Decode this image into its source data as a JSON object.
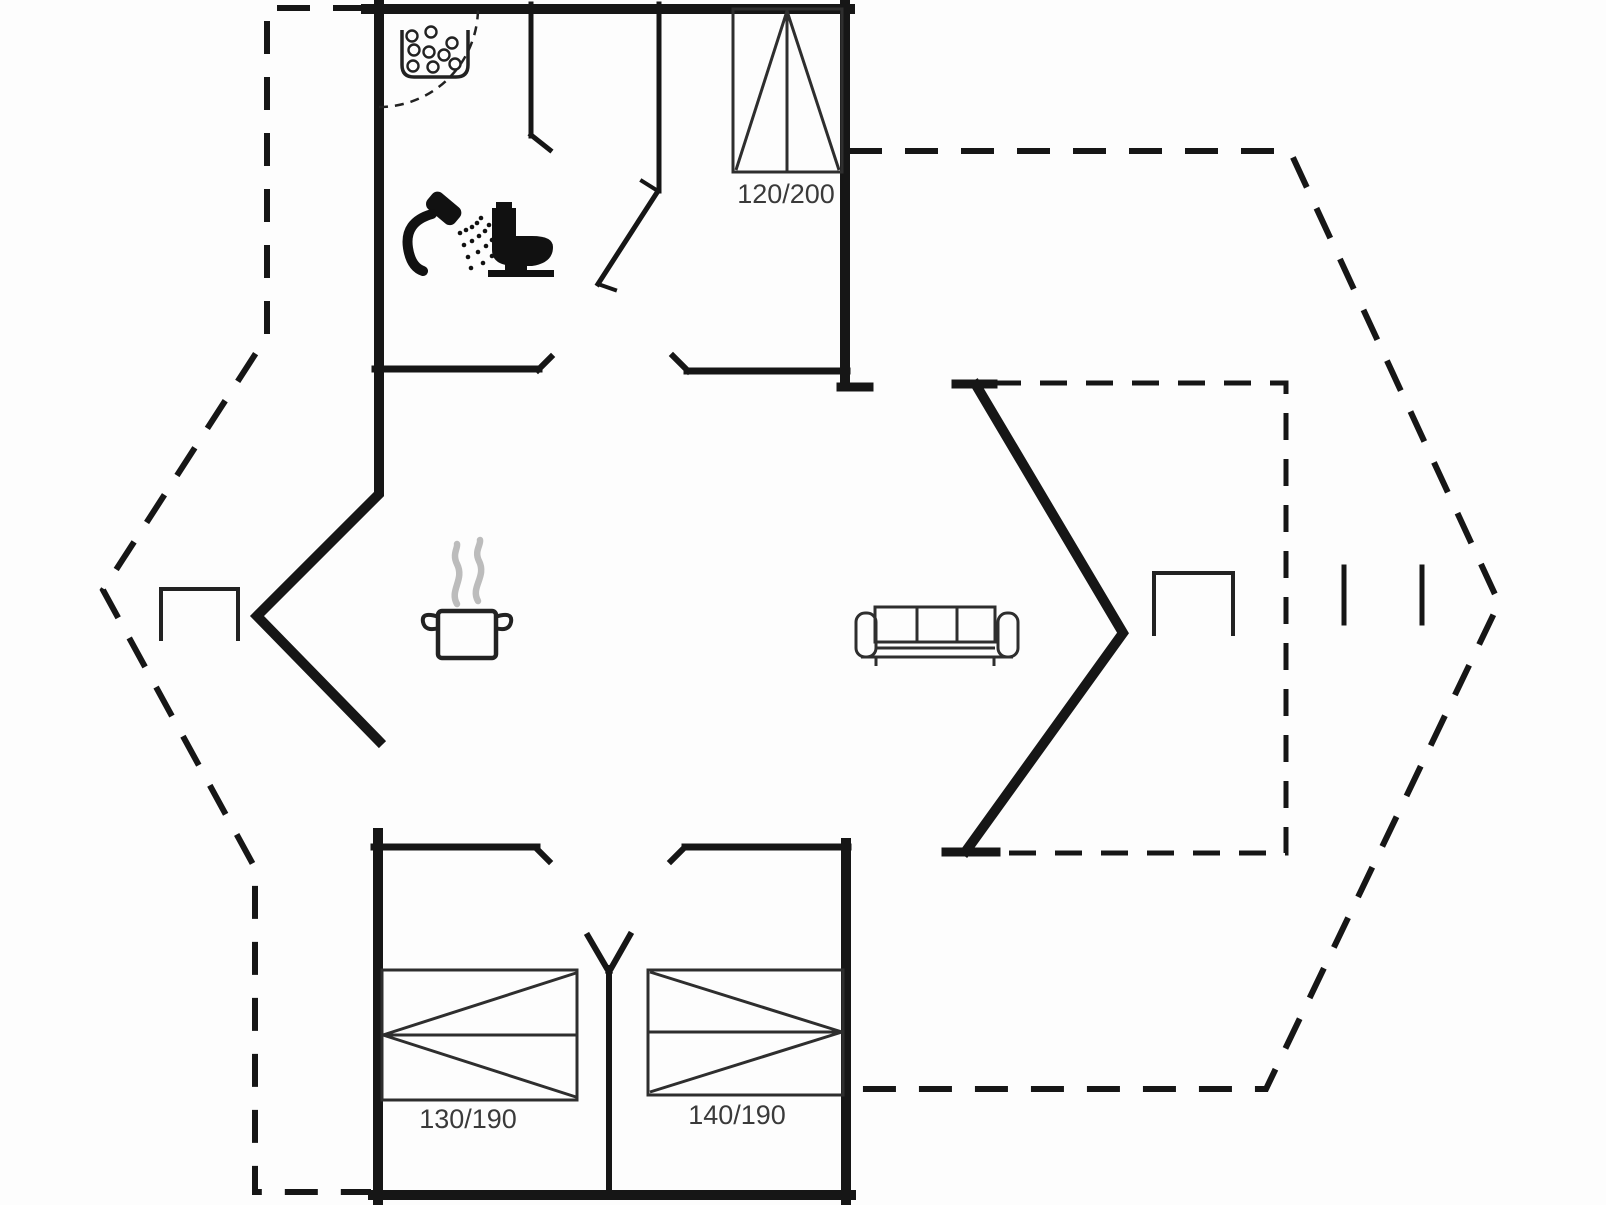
{
  "page": {
    "title": "Holiday house floor plan",
    "background": "#fdfdfd",
    "wall_color": "#161616",
    "label_color": "#3a3a3a",
    "steam_color": "#bcbcbc"
  },
  "floorplan": {
    "type": "floor-plan-drawing",
    "beds": [
      {
        "name": "double-bed-top-right",
        "size_label": "120/200"
      },
      {
        "name": "double-bed-bottom-left",
        "size_label": "130/190"
      },
      {
        "name": "double-bed-bottom-right",
        "size_label": "140/190"
      }
    ],
    "fixtures": [
      "kitchen-sink",
      "shower",
      "toilet",
      "cooking-pot-with-steam",
      "sofa",
      "side-table-left",
      "side-table-right",
      "terrace-rail-marks"
    ],
    "boundaries": [
      "outer-terrace-dashed-outline",
      "inner-terrace-dashed-outline",
      "solid-exterior-and-interior-walls",
      "door-swing-arc"
    ]
  }
}
